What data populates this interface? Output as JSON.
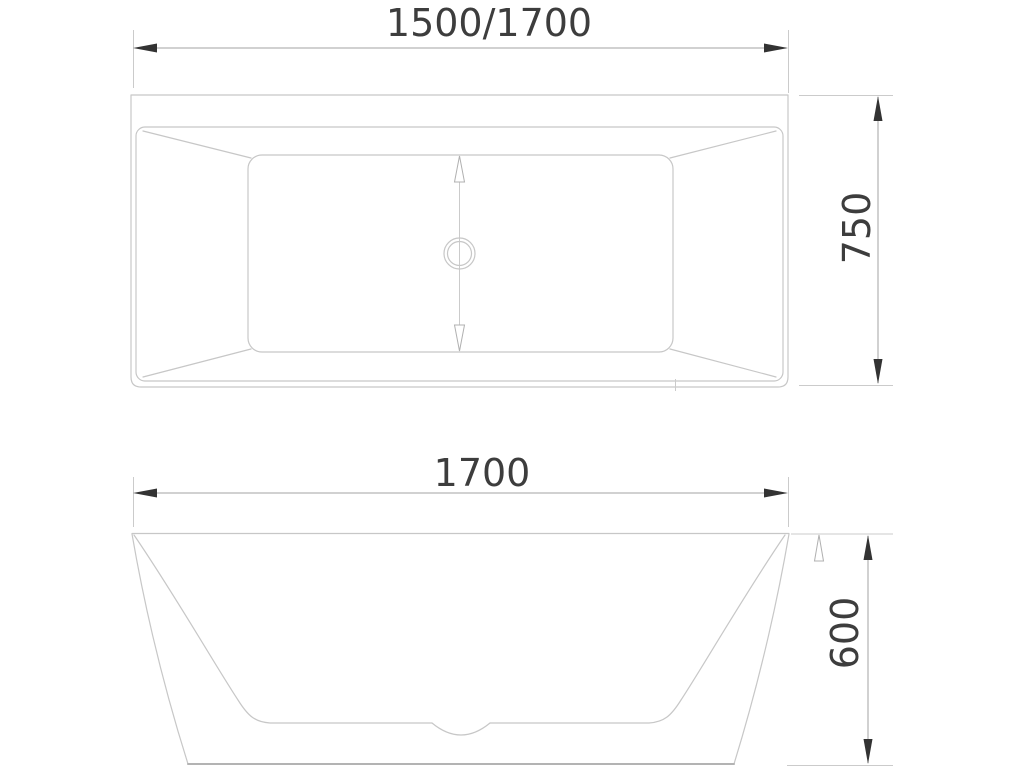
{
  "drawing": {
    "dimensions": {
      "top_length": "1500/1700",
      "top_width": "750",
      "front_length": "1700",
      "front_height": "600"
    },
    "colors": {
      "background": "#ffffff",
      "outline": "#c7c7c7",
      "outline_strong": "#b3b3b3",
      "dimension_line": "#a3a3a3",
      "extension_line": "#cbcbcb",
      "open_arrow": "#b0b0b0",
      "arrow": "#333333",
      "text": "#3d3d3d"
    }
  }
}
